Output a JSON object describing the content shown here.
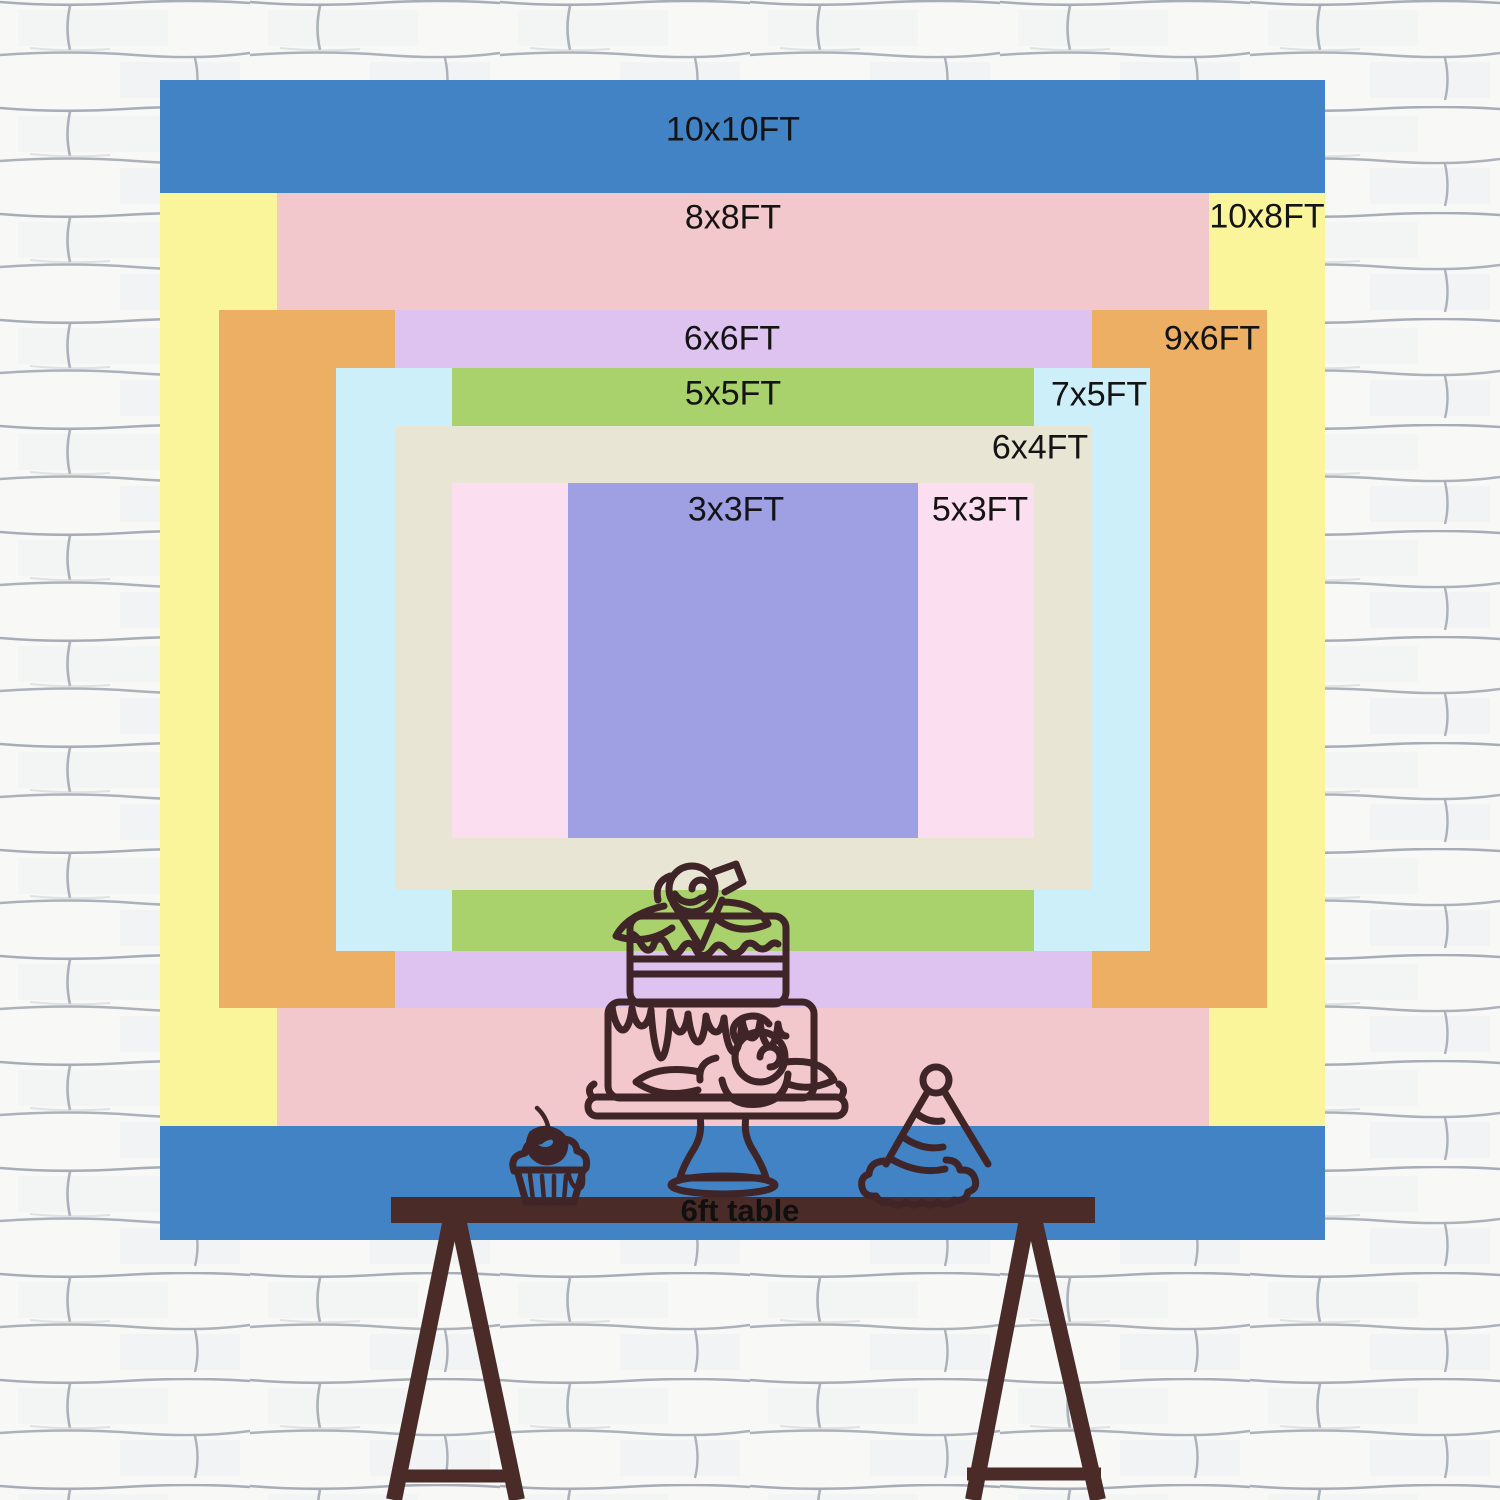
{
  "title": "Backdrop size comparison diagram",
  "wall": {
    "base_color": "#f8f8f7",
    "mortar_line_color": "#98a0ab",
    "shadow_color": "#e8eaed"
  },
  "sizes": [
    {
      "label": "10x10FT",
      "color": "#4183c4",
      "rect": {
        "left": 160,
        "top": 80,
        "width": 1165,
        "height": 1160
      },
      "label_pos": {
        "x": 733,
        "y": 130
      }
    },
    {
      "label": "10x8FT",
      "color": "#faf49b",
      "rect": {
        "left": 160,
        "top": 193,
        "width": 1165,
        "height": 933
      },
      "label_pos": {
        "x": 1267,
        "y": 217
      }
    },
    {
      "label": "8x8FT",
      "color": "#f3c8cc",
      "rect": {
        "left": 277,
        "top": 193,
        "width": 932,
        "height": 933
      },
      "label_pos": {
        "x": 733,
        "y": 218
      }
    },
    {
      "label": "9x6FT",
      "color": "#ecaf64",
      "rect": {
        "left": 219,
        "top": 310,
        "width": 1048,
        "height": 698
      },
      "label_pos": {
        "x": 1212,
        "y": 339
      }
    },
    {
      "label": "6x6FT",
      "color": "#dec2ef",
      "rect": {
        "left": 395,
        "top": 310,
        "width": 697,
        "height": 698
      },
      "label_pos": {
        "x": 732,
        "y": 339
      }
    },
    {
      "label": "7x5FT",
      "color": "#cdeff9",
      "rect": {
        "left": 336,
        "top": 368,
        "width": 814,
        "height": 583
      },
      "label_pos": {
        "x": 1099,
        "y": 395
      }
    },
    {
      "label": "5x5FT",
      "color": "#a9d16c",
      "rect": {
        "left": 452,
        "top": 368,
        "width": 582,
        "height": 583
      },
      "label_pos": {
        "x": 733,
        "y": 394
      }
    },
    {
      "label": "6x4FT",
      "color": "#e9e5d5",
      "rect": {
        "left": 395,
        "top": 426,
        "width": 697,
        "height": 464
      },
      "label_pos": {
        "x": 1040,
        "y": 448
      }
    },
    {
      "label": "5x3FT",
      "color": "#fbdff0",
      "rect": {
        "left": 452,
        "top": 483,
        "width": 582,
        "height": 355
      },
      "label_pos": {
        "x": 980,
        "y": 510
      }
    },
    {
      "label": "3x3FT",
      "color": "#9f9fe3",
      "rect": {
        "left": 568,
        "top": 483,
        "width": 350,
        "height": 355
      },
      "label_pos": {
        "x": 736,
        "y": 510
      }
    }
  ],
  "table": {
    "label": "6ft table",
    "wood_color": "#4a2b28",
    "label_color": "#101010"
  },
  "illustration": {
    "line_color": "#3f2428",
    "items": [
      "tiered-cake-icon",
      "cupcake-icon",
      "party-hat-icon",
      "trestle-table-icon"
    ]
  }
}
